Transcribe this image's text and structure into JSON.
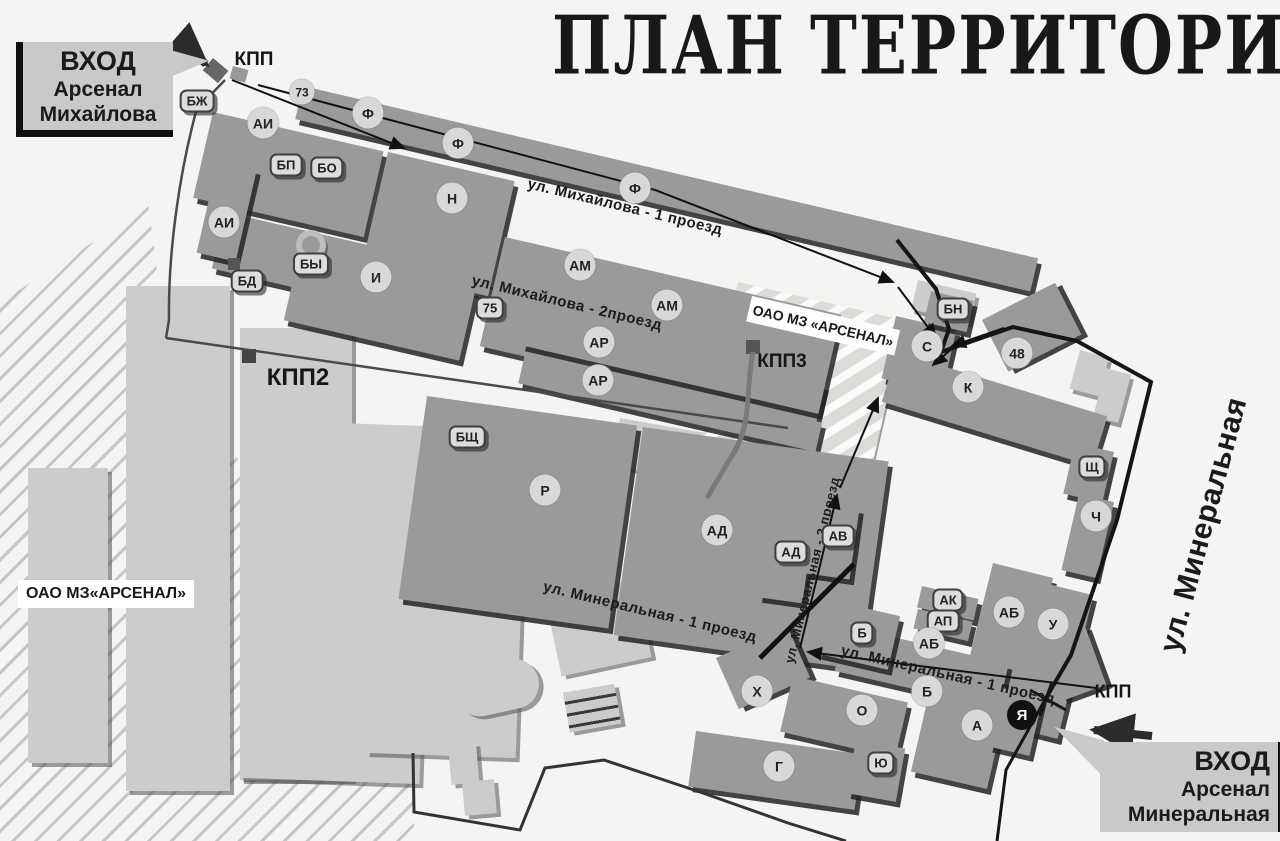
{
  "title": "ПЛАН ТЕРРИТОРИИ",
  "signs": {
    "mikhailova": {
      "line1": "ВХОД",
      "line2": "Арсенал",
      "line3": "Михайлова"
    },
    "mineralnaya": {
      "line1": "ВХОД",
      "line2": "Арсенал",
      "line3": "Минеральная"
    }
  },
  "areas": {
    "left_factory": "ОАО МЗ«АРСЕНАЛ»",
    "right_factory": "ОАО МЗ «АРСЕНАЛ»"
  },
  "map": {
    "checkpoints": [
      {
        "label": "КПП",
        "x": 254,
        "y": 60,
        "size": 19
      },
      {
        "label": "КПП2",
        "x": 298,
        "y": 378,
        "size": 24
      },
      {
        "label": "КПП3",
        "x": 782,
        "y": 362,
        "size": 19
      },
      {
        "label": "КПП",
        "x": 1113,
        "y": 692,
        "size": 18
      }
    ],
    "streets": [
      {
        "label": "ул. Михайлова - 1 проезд",
        "x": 625,
        "y": 207,
        "rot": 13.5,
        "size": 15
      },
      {
        "label": "ул. Михайлова - 2проезд",
        "x": 567,
        "y": 303,
        "rot": 13.5,
        "size": 15
      },
      {
        "label": "ул. Минеральная - 1 проезд",
        "x": 650,
        "y": 612,
        "rot": 13.5,
        "size": 15
      },
      {
        "label": "ул. Минеральная - 1 проезд",
        "x": 948,
        "y": 675,
        "rot": 13,
        "size": 15
      },
      {
        "label": "ул. Минеральная - 2 проезд",
        "x": 812,
        "y": 570,
        "rot": -76,
        "size": 13
      },
      {
        "label": "ул. Минеральная",
        "x": 1204,
        "y": 525,
        "rot": -75,
        "size": 30
      }
    ],
    "markers": [
      {
        "label": "БЖ",
        "x": 197,
        "y": 101,
        "kind": "pill"
      },
      {
        "label": "73",
        "x": 302,
        "y": 92,
        "kind": "circle-sm"
      },
      {
        "label": "Ф",
        "x": 368,
        "y": 113,
        "kind": "circle"
      },
      {
        "label": "Ф",
        "x": 458,
        "y": 143,
        "kind": "circle"
      },
      {
        "label": "Ф",
        "x": 635,
        "y": 188,
        "kind": "circle"
      },
      {
        "label": "АИ",
        "x": 263,
        "y": 123,
        "kind": "circle"
      },
      {
        "label": "БП",
        "x": 286,
        "y": 165,
        "kind": "pill"
      },
      {
        "label": "БО",
        "x": 327,
        "y": 168,
        "kind": "pill"
      },
      {
        "label": "Н",
        "x": 452,
        "y": 198,
        "kind": "circle"
      },
      {
        "label": "АИ",
        "x": 224,
        "y": 222,
        "kind": "circle"
      },
      {
        "label": "БД",
        "x": 247,
        "y": 281,
        "kind": "pill"
      },
      {
        "label": "",
        "x": 311,
        "y": 245,
        "kind": "ring"
      },
      {
        "label": "БЫ",
        "x": 311,
        "y": 264,
        "kind": "pill"
      },
      {
        "label": "И",
        "x": 376,
        "y": 277,
        "kind": "circle"
      },
      {
        "label": "75",
        "x": 490,
        "y": 308,
        "kind": "pill"
      },
      {
        "label": "АМ",
        "x": 580,
        "y": 265,
        "kind": "circle"
      },
      {
        "label": "АМ",
        "x": 667,
        "y": 305,
        "kind": "circle"
      },
      {
        "label": "АР",
        "x": 599,
        "y": 342,
        "kind": "circle"
      },
      {
        "label": "АР",
        "x": 598,
        "y": 380,
        "kind": "circle"
      },
      {
        "label": "БЩ",
        "x": 467,
        "y": 437,
        "kind": "pill"
      },
      {
        "label": "Р",
        "x": 545,
        "y": 490,
        "kind": "circle"
      },
      {
        "label": "АД",
        "x": 717,
        "y": 530,
        "kind": "circle"
      },
      {
        "label": "АД",
        "x": 791,
        "y": 552,
        "kind": "pill"
      },
      {
        "label": "АВ",
        "x": 838,
        "y": 536,
        "kind": "pill"
      },
      {
        "label": "БН",
        "x": 953,
        "y": 309,
        "kind": "pill"
      },
      {
        "label": "С",
        "x": 927,
        "y": 346,
        "kind": "circle"
      },
      {
        "label": "К",
        "x": 968,
        "y": 387,
        "kind": "circle"
      },
      {
        "label": "48",
        "x": 1017,
        "y": 353,
        "kind": "circle"
      },
      {
        "label": "Щ",
        "x": 1092,
        "y": 467,
        "kind": "pill"
      },
      {
        "label": "Ч",
        "x": 1096,
        "y": 516,
        "kind": "circle"
      },
      {
        "label": "АК",
        "x": 948,
        "y": 600,
        "kind": "pill"
      },
      {
        "label": "АП",
        "x": 943,
        "y": 621,
        "kind": "pill"
      },
      {
        "label": "АБ",
        "x": 929,
        "y": 643,
        "kind": "circle"
      },
      {
        "label": "АБ",
        "x": 1009,
        "y": 612,
        "kind": "circle"
      },
      {
        "label": "У",
        "x": 1053,
        "y": 624,
        "kind": "circle"
      },
      {
        "label": "Б",
        "x": 862,
        "y": 633,
        "kind": "pill"
      },
      {
        "label": "Б",
        "x": 927,
        "y": 691,
        "kind": "circle"
      },
      {
        "label": "Х",
        "x": 757,
        "y": 691,
        "kind": "circle"
      },
      {
        "label": "О",
        "x": 862,
        "y": 710,
        "kind": "circle"
      },
      {
        "label": "Г",
        "x": 779,
        "y": 766,
        "kind": "circle"
      },
      {
        "label": "Ю",
        "x": 881,
        "y": 763,
        "kind": "pill"
      },
      {
        "label": "А",
        "x": 977,
        "y": 725,
        "kind": "circle"
      },
      {
        "label": "Я",
        "x": 1022,
        "y": 715,
        "kind": "dark"
      }
    ]
  }
}
